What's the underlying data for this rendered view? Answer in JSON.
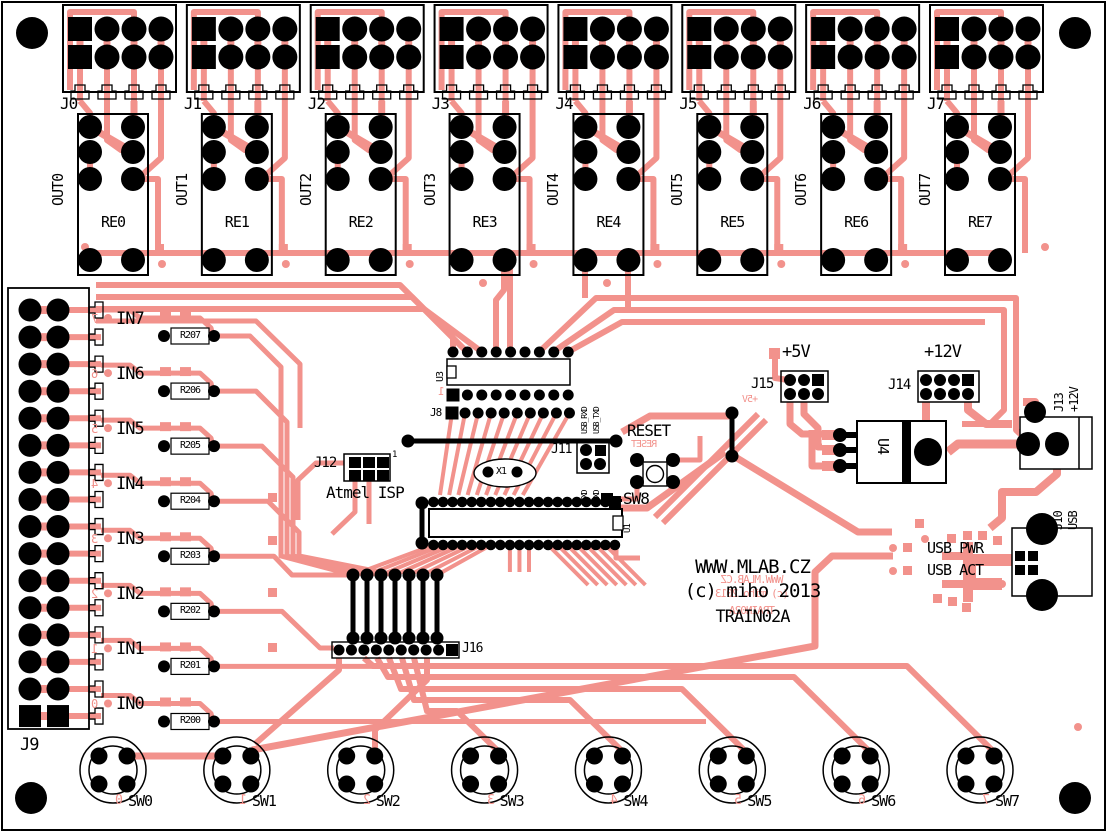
{
  "board": {
    "name": "TRAIN02A relay board layout",
    "colors": {
      "copper": "#F2928C",
      "silk": "#000000",
      "bg": "#FFFFFF"
    }
  },
  "title_block": {
    "lines": [
      "WWW.MLAB.CZ",
      "(c) miho 2013",
      "TRAIN02A"
    ]
  },
  "output_channels": [
    {
      "connector": "J0",
      "out": "OUT0",
      "relay": "RE0"
    },
    {
      "connector": "J1",
      "out": "OUT1",
      "relay": "RE1"
    },
    {
      "connector": "J2",
      "out": "OUT2",
      "relay": "RE2"
    },
    {
      "connector": "J3",
      "out": "OUT3",
      "relay": "RE3"
    },
    {
      "connector": "J4",
      "out": "OUT4",
      "relay": "RE4"
    },
    {
      "connector": "J5",
      "out": "OUT5",
      "relay": "RE5"
    },
    {
      "connector": "J6",
      "out": "OUT6",
      "relay": "RE6"
    },
    {
      "connector": "J7",
      "out": "OUT7",
      "relay": "RE7"
    }
  ],
  "input_connector": {
    "label": "J9"
  },
  "input_channels": [
    {
      "label": "IN7",
      "resistor": "R207",
      "digit": "7"
    },
    {
      "label": "IN6",
      "resistor": "R206",
      "digit": "6"
    },
    {
      "label": "IN5",
      "resistor": "R205",
      "digit": "5"
    },
    {
      "label": "IN4",
      "resistor": "R204",
      "digit": "4"
    },
    {
      "label": "IN3",
      "resistor": "R203",
      "digit": "3"
    },
    {
      "label": "IN2",
      "resistor": "R202",
      "digit": "2"
    },
    {
      "label": "IN1",
      "resistor": "R201",
      "digit": "1"
    },
    {
      "label": "IN0",
      "resistor": "R200",
      "digit": "0"
    }
  ],
  "switches": [
    {
      "label": "SW0",
      "digit": "0"
    },
    {
      "label": "SW1",
      "digit": "1"
    },
    {
      "label": "SW2",
      "digit": "2"
    },
    {
      "label": "SW3",
      "digit": "3"
    },
    {
      "label": "SW4",
      "digit": "4"
    },
    {
      "label": "SW5",
      "digit": "5"
    },
    {
      "label": "SW6",
      "digit": "6"
    },
    {
      "label": "SW7",
      "digit": "7"
    }
  ],
  "mcu": {
    "label": "U1"
  },
  "driver": {
    "label": "U3"
  },
  "header_j8": {
    "label": "J8",
    "pin1": "1"
  },
  "crystal": {
    "label": "X1"
  },
  "isp": {
    "label": "J12",
    "caption": "Atmel ISP",
    "pin1": "1"
  },
  "serial_header": {
    "label": "J11",
    "top": [
      "USB_RXD",
      "USB_TXD"
    ],
    "bottom": [
      "TXD",
      "RXD"
    ]
  },
  "reset": {
    "label": "RESET",
    "mirror": "RESET"
  },
  "reset_switch": {
    "label": "SW8"
  },
  "jumper_block": {
    "label": "J16"
  },
  "power": {
    "v5": {
      "label": "+5V",
      "header": "J15",
      "mirror": "+5V"
    },
    "v12": {
      "label": "+12V",
      "header": "J14"
    },
    "jack": {
      "label": "J13",
      "voltage": "+12V"
    },
    "regulator": {
      "label": "U4"
    }
  },
  "usb": {
    "connector": "J10",
    "type": "USB",
    "pwr_led": "USB PWR",
    "act_led": "USB ACT"
  }
}
